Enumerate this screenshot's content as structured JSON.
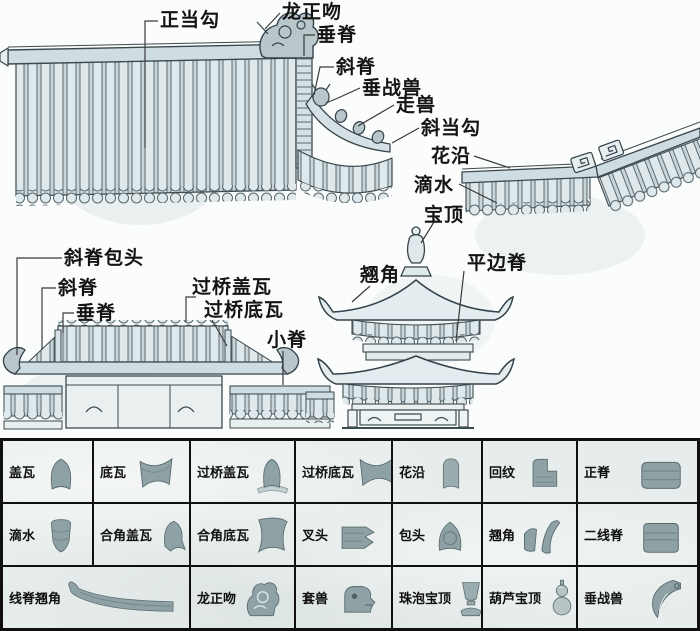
{
  "colors": {
    "tile_fill": "#dfe9ec",
    "tile_gap": "#c9d5d9",
    "outline": "#3c4a4e",
    "ornament_fill": "#b9c7cb",
    "item_gray": "#8ea1a4",
    "item_gray_light": "#b7c4c5",
    "item_stroke": "#5a6b6e",
    "table_border": "#101010",
    "background": "#fbfcfc"
  },
  "annotations": {
    "roof_main": {
      "zhengdanggou": "正当勾",
      "longzhengwen": "龙正吻",
      "chuiji": "垂脊",
      "xieji": "斜脊",
      "chuizhanshou": "垂战兽",
      "zoushou": "走兽",
      "xiedanggou": "斜当勾",
      "huayan": "花沿",
      "dishui": "滴水",
      "baoding": "宝顶"
    },
    "wall": {
      "xiejibaotou": "斜脊包头",
      "xieji": "斜脊",
      "chuiji": "垂脊",
      "guoqiaogaiwa": "过桥盖瓦",
      "guoqiaodiwa": "过桥底瓦",
      "xiaoji": "小脊"
    },
    "pavilion": {
      "qiaojiao": "翘角",
      "pingbianji": "平边脊"
    }
  },
  "parts_table": {
    "rows": [
      {
        "cells": [
          {
            "label": "盖瓦"
          },
          {
            "label": "底瓦"
          },
          {
            "label": "过桥盖瓦"
          },
          {
            "label": "过桥底瓦"
          },
          {
            "label": "花沿"
          },
          {
            "label": "回纹"
          },
          {
            "label": "正脊"
          }
        ]
      },
      {
        "cells": [
          {
            "label": "滴水"
          },
          {
            "label": "合角盖瓦"
          },
          {
            "label": "合角底瓦"
          },
          {
            "label": "叉头"
          },
          {
            "label": "包头"
          },
          {
            "label": "翘角"
          },
          {
            "label": "二线脊"
          }
        ]
      },
      {
        "cells": [
          {
            "label": "线脊翘角"
          },
          {
            "label": "龙正吻"
          },
          {
            "label": "套兽"
          },
          {
            "label": "珠泡宝顶"
          },
          {
            "label": "葫芦宝顶"
          },
          {
            "label": "垂战兽"
          }
        ]
      }
    ]
  }
}
